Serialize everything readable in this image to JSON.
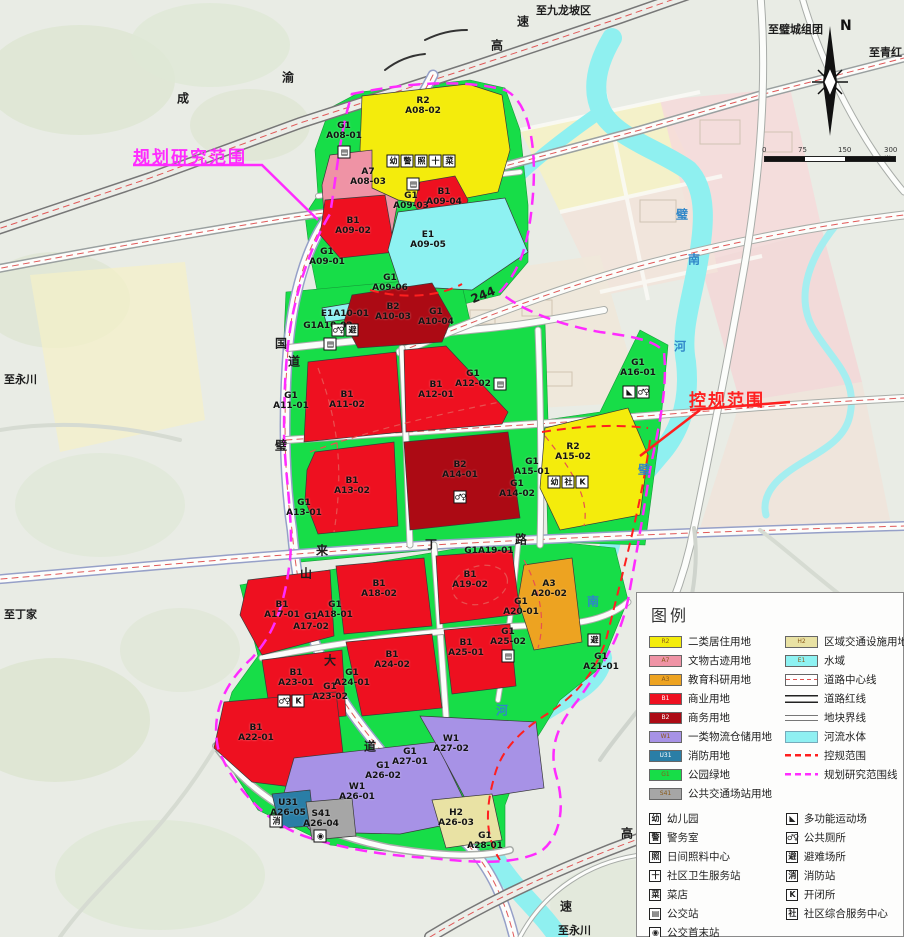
{
  "palette": {
    "R2": "#f4ec0c",
    "A7": "#ef93a5",
    "A3": "#eda321",
    "B1": "#ee1020",
    "B2": "#ac0a14",
    "W1": "#a792e6",
    "U31": "#2a7ea6",
    "G1": "#17dd48",
    "S41": "#a6a6a6",
    "H2": "#e9e2a4",
    "E1": "#8ef2f2",
    "river": "#8ff0f0",
    "road_center": "#e05858",
    "kg_red": "#ff1f1f",
    "plan_magenta": "#ff2bff",
    "bg": "#e9ece5",
    "faded_pink": "#f6dcdc",
    "faded_yellow": "#f6f2c4",
    "faded_cream": "#efe8da"
  },
  "annotations": {
    "plan_scope": "规划研究范围",
    "control_scope": "控规范围"
  },
  "compass": {
    "label": "N"
  },
  "scalebar": {
    "labels": [
      "0",
      "75",
      "150",
      "300米"
    ]
  },
  "map_labels": {
    "destinations": [
      {
        "t": "至九龙坡区",
        "x": 536,
        "y": 2
      },
      {
        "t": "至璧城组团",
        "x": 768,
        "y": 21
      },
      {
        "t": "至青红",
        "x": 869,
        "y": 44
      },
      {
        "t": "至永川",
        "x": 4,
        "y": 371
      },
      {
        "t": "至丁家",
        "x": 4,
        "y": 606
      },
      {
        "t": "至永川",
        "x": 558,
        "y": 922
      }
    ],
    "road_chars": [
      {
        "t": "成",
        "x": 183,
        "y": 98
      },
      {
        "t": "渝",
        "x": 288,
        "y": 77
      },
      {
        "t": "高",
        "x": 497,
        "y": 45
      },
      {
        "t": "速",
        "x": 523,
        "y": 21
      },
      {
        "t": "国",
        "x": 281,
        "y": 343
      },
      {
        "t": "道",
        "x": 294,
        "y": 361
      },
      {
        "t": "244",
        "x": 483,
        "y": 295,
        "r": -22
      },
      {
        "t": "璧",
        "x": 281,
        "y": 445
      },
      {
        "t": "山",
        "x": 306,
        "y": 573
      },
      {
        "t": "大",
        "x": 330,
        "y": 660
      },
      {
        "t": "道",
        "x": 370,
        "y": 746
      },
      {
        "t": "来",
        "x": 322,
        "y": 550
      },
      {
        "t": "丁",
        "x": 431,
        "y": 544
      },
      {
        "t": "路",
        "x": 521,
        "y": 539
      },
      {
        "t": "高",
        "x": 627,
        "y": 833
      },
      {
        "t": "速",
        "x": 566,
        "y": 906
      }
    ],
    "river_chars": [
      {
        "t": "璧",
        "x": 682,
        "y": 214
      },
      {
        "t": "南",
        "x": 694,
        "y": 259
      },
      {
        "t": "河",
        "x": 680,
        "y": 346
      },
      {
        "t": "璧",
        "x": 644,
        "y": 469
      },
      {
        "t": "南",
        "x": 593,
        "y": 601
      },
      {
        "t": "河",
        "x": 502,
        "y": 710
      }
    ]
  },
  "parcels": [
    {
      "code": "G1",
      "id": "A08-01",
      "x": 344,
      "y": 131
    },
    {
      "code": "R2",
      "id": "A08-02",
      "x": 423,
      "y": 106
    },
    {
      "code": "A7",
      "id": "A08-03",
      "x": 368,
      "y": 177
    },
    {
      "code": "G1",
      "id": "A09-03",
      "x": 411,
      "y": 201
    },
    {
      "code": "B1",
      "id": "A09-04",
      "x": 444,
      "y": 197
    },
    {
      "code": "B1",
      "id": "A09-02",
      "x": 353,
      "y": 226
    },
    {
      "code": "E1",
      "id": "A09-05",
      "x": 428,
      "y": 240
    },
    {
      "code": "G1",
      "id": "A09-01",
      "x": 327,
      "y": 257
    },
    {
      "code": "G1",
      "id": "A09-06",
      "x": 390,
      "y": 283
    },
    {
      "code": "E1",
      "id": "A10-01",
      "x": 345,
      "y": 314,
      "inline": true
    },
    {
      "code": "G1",
      "id": "A10-02",
      "x": 328,
      "y": 326,
      "inline": true
    },
    {
      "code": "B2",
      "id": "A10-03",
      "x": 393,
      "y": 312
    },
    {
      "code": "G1",
      "id": "A10-04",
      "x": 436,
      "y": 317
    },
    {
      "code": "G1",
      "id": "A11-01",
      "x": 291,
      "y": 401
    },
    {
      "code": "B1",
      "id": "A11-02",
      "x": 347,
      "y": 400
    },
    {
      "code": "B1",
      "id": "A12-01",
      "x": 436,
      "y": 390
    },
    {
      "code": "G1",
      "id": "A12-02",
      "x": 473,
      "y": 379
    },
    {
      "code": "B1",
      "id": "A13-02",
      "x": 352,
      "y": 486
    },
    {
      "code": "G1",
      "id": "A13-01",
      "x": 304,
      "y": 508
    },
    {
      "code": "B2",
      "id": "A14-01",
      "x": 460,
      "y": 470
    },
    {
      "code": "G1",
      "id": "A14-02",
      "x": 517,
      "y": 489
    },
    {
      "code": "G1",
      "id": "A15-01",
      "x": 532,
      "y": 467
    },
    {
      "code": "R2",
      "id": "A15-02",
      "x": 573,
      "y": 452
    },
    {
      "code": "G1",
      "id": "A16-01",
      "x": 638,
      "y": 368
    },
    {
      "code": "B1",
      "id": "A17-01",
      "x": 282,
      "y": 610
    },
    {
      "code": "G1",
      "id": "A17-02",
      "x": 311,
      "y": 622
    },
    {
      "code": "G1",
      "id": "A18-01",
      "x": 335,
      "y": 610
    },
    {
      "code": "B1",
      "id": "A18-02",
      "x": 379,
      "y": 589
    },
    {
      "code": "G1",
      "id": "A19-01",
      "x": 489,
      "y": 551,
      "inline": true
    },
    {
      "code": "B1",
      "id": "A19-02",
      "x": 470,
      "y": 580
    },
    {
      "code": "A3",
      "id": "A20-02",
      "x": 549,
      "y": 589
    },
    {
      "code": "G1",
      "id": "A20-01",
      "x": 521,
      "y": 607
    },
    {
      "code": "G1",
      "id": "A21-01",
      "x": 601,
      "y": 662
    },
    {
      "code": "B1",
      "id": "A22-01",
      "x": 256,
      "y": 733
    },
    {
      "code": "B1",
      "id": "A23-01",
      "x": 296,
      "y": 678
    },
    {
      "code": "G1",
      "id": "A23-02",
      "x": 330,
      "y": 692
    },
    {
      "code": "B1",
      "id": "A24-02",
      "x": 392,
      "y": 660
    },
    {
      "code": "G1",
      "id": "A24-01",
      "x": 352,
      "y": 678
    },
    {
      "code": "B1",
      "id": "A25-01",
      "x": 466,
      "y": 648
    },
    {
      "code": "G1",
      "id": "A25-02",
      "x": 508,
      "y": 637
    },
    {
      "code": "W1",
      "id": "A26-01",
      "x": 357,
      "y": 792
    },
    {
      "code": "G1",
      "id": "A26-02",
      "x": 383,
      "y": 771
    },
    {
      "code": "H2",
      "id": "A26-03",
      "x": 456,
      "y": 818
    },
    {
      "code": "S41",
      "id": "A26-04",
      "x": 321,
      "y": 819
    },
    {
      "code": "U31",
      "id": "A26-05",
      "x": 288,
      "y": 808
    },
    {
      "code": "G1",
      "id": "A27-01",
      "x": 410,
      "y": 757
    },
    {
      "code": "W1",
      "id": "A27-02",
      "x": 451,
      "y": 744
    },
    {
      "code": "G1",
      "id": "A28-01",
      "x": 485,
      "y": 841
    }
  ],
  "map_icons": [
    {
      "x": 421,
      "y": 161,
      "g": [
        "幼",
        "警",
        "照",
        "十",
        "菜"
      ]
    },
    {
      "x": 344,
      "y": 152,
      "g": [
        "▤"
      ]
    },
    {
      "x": 413,
      "y": 184,
      "g": [
        "▤"
      ]
    },
    {
      "x": 345,
      "y": 330,
      "g": [
        "♂♀",
        "避"
      ]
    },
    {
      "x": 330,
      "y": 344,
      "g": [
        "▤"
      ]
    },
    {
      "x": 460,
      "y": 497,
      "g": [
        "♂♀"
      ]
    },
    {
      "x": 568,
      "y": 482,
      "g": [
        "幼",
        "社",
        "K"
      ]
    },
    {
      "x": 636,
      "y": 392,
      "g": [
        "◣",
        "♂♀"
      ]
    },
    {
      "x": 291,
      "y": 701,
      "g": [
        "♂♀",
        "K"
      ]
    },
    {
      "x": 594,
      "y": 640,
      "g": [
        "避"
      ]
    },
    {
      "x": 276,
      "y": 821,
      "g": [
        "消"
      ]
    },
    {
      "x": 320,
      "y": 836,
      "g": [
        "◉"
      ]
    },
    {
      "x": 500,
      "y": 384,
      "g": [
        "▤"
      ]
    },
    {
      "x": 508,
      "y": 656,
      "g": [
        "▤"
      ]
    }
  ],
  "legend": {
    "title": "图例",
    "landuse_left": [
      {
        "code": "R2",
        "color_key": "R2",
        "label": "二类居住用地"
      },
      {
        "code": "A7",
        "color_key": "A7",
        "label": "文物古迹用地"
      },
      {
        "code": "A3",
        "color_key": "A3",
        "label": "教育科研用地"
      },
      {
        "code": "B1",
        "color_key": "B1",
        "label": "商业用地",
        "dark": true
      },
      {
        "code": "B2",
        "color_key": "B2",
        "label": "商务用地",
        "dark": true
      },
      {
        "code": "W1",
        "color_key": "W1",
        "label": "一类物流仓储用地"
      },
      {
        "code": "U31",
        "color_key": "U31",
        "label": "消防用地",
        "dark": true
      },
      {
        "code": "G1",
        "color_key": "G1",
        "label": "公园绿地"
      },
      {
        "code": "S41",
        "color_key": "S41",
        "label": "公共交通场站用地"
      }
    ],
    "landuse_right": [
      {
        "code": "H2",
        "color_key": "H2",
        "label": "区域交通设施用地"
      },
      {
        "code": "E1",
        "color_key": "E1",
        "label": "水域"
      },
      {
        "kind": "centerline",
        "label": "道路中心线"
      },
      {
        "kind": "redline",
        "label": "道路红线"
      },
      {
        "kind": "parcelline",
        "label": "地块界线"
      },
      {
        "kind": "river",
        "label": "河流水体"
      },
      {
        "kind": "kg",
        "label": "控规范围"
      },
      {
        "kind": "plan",
        "label": "规划研究范围线"
      }
    ],
    "facilities_left": [
      {
        "glyph": "幼",
        "label": "幼儿园"
      },
      {
        "glyph": "警",
        "label": "警务室"
      },
      {
        "glyph": "照",
        "label": "日间照料中心"
      },
      {
        "glyph": "十",
        "label": "社区卫生服务站"
      },
      {
        "glyph": "菜",
        "label": "菜店"
      },
      {
        "glyph": "▤",
        "label": "公交站"
      },
      {
        "glyph": "◉",
        "label": "公交首末站"
      }
    ],
    "facilities_right": [
      {
        "glyph": "◣",
        "label": "多功能运动场"
      },
      {
        "glyph": "♂♀",
        "label": "公共厕所"
      },
      {
        "glyph": "避",
        "label": "避难场所"
      },
      {
        "glyph": "消",
        "label": "消防站"
      },
      {
        "glyph": "K",
        "label": "开闭所"
      },
      {
        "glyph": "社",
        "label": "社区综合服务中心"
      }
    ]
  }
}
